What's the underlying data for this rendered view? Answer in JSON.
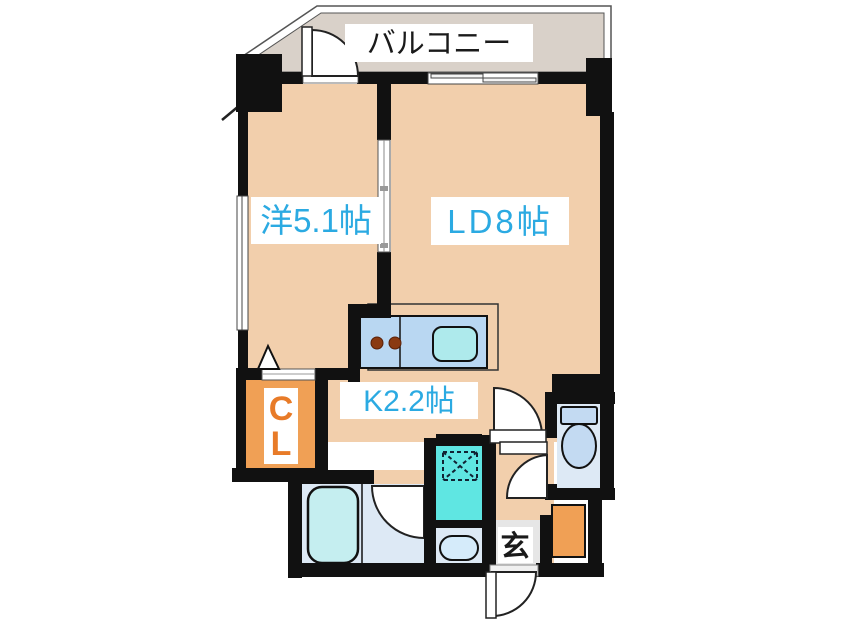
{
  "plan": {
    "balcony_label": "バルコニー",
    "rooms": {
      "western": {
        "label": "洋5.1帖"
      },
      "living_dining": {
        "label": "LD8帖"
      },
      "kitchen": {
        "label": "K2.2帖"
      },
      "closet": {
        "line1": "C",
        "line2": "L"
      },
      "entrance": {
        "label": "玄"
      }
    },
    "colors": {
      "floor": "#f2cfac",
      "balcony_floor": "#d9d1c9",
      "closet": "#f0a055",
      "shoebox": "#f0a055",
      "washer": "#5fe6e2",
      "wet_room": "#dde9f5",
      "tub": "#c5eef0",
      "basin": "#d5ebfa",
      "toilet_fixture": "#c3daf2",
      "counter": "#b9d7f2",
      "counter_sink": "#aeeaec",
      "burner": "#8a3a12",
      "entrance_floor": "#e6e6e6",
      "wall": "#111111",
      "label_blue": "#2baae2",
      "label_orange": "#e87b28",
      "label_black": "#1a1a1a"
    }
  }
}
